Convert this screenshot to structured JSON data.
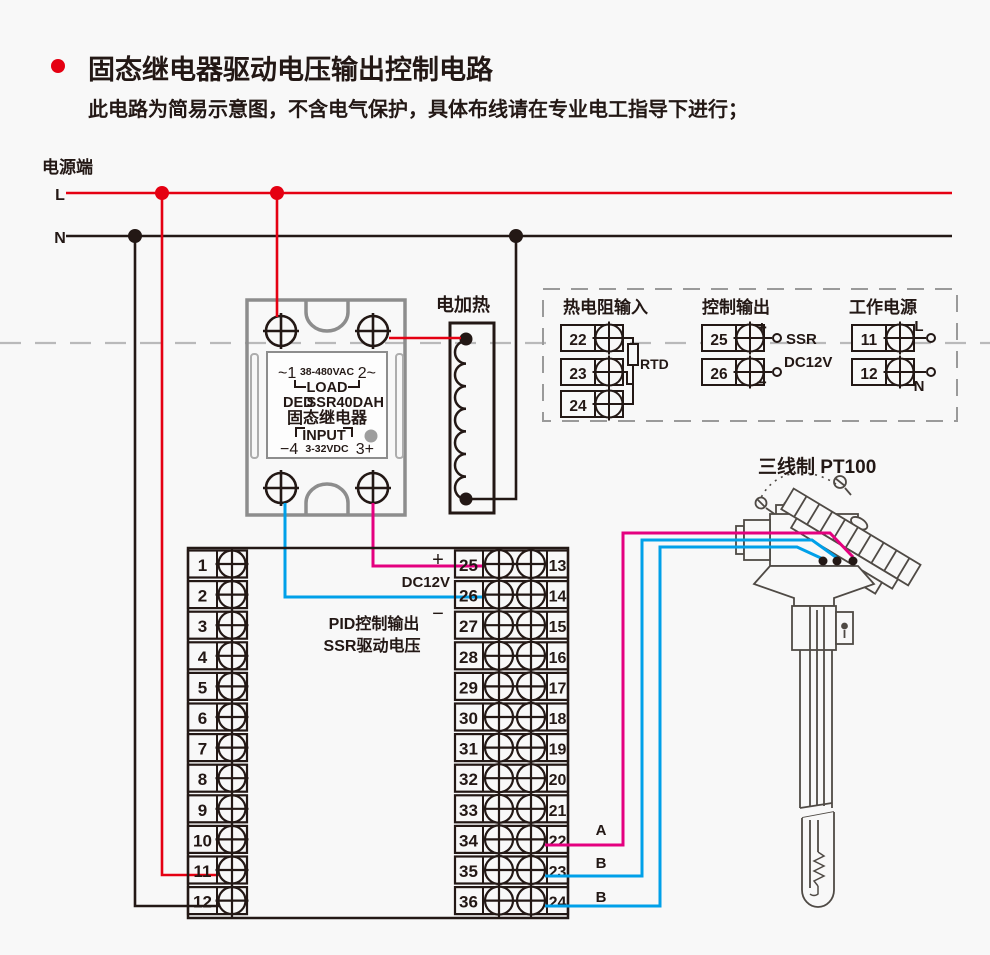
{
  "header": {
    "title": "固态继电器驱动电压输出控制电路",
    "subtitle": "此电路为简易示意图，不含电气保护，具体布线请在专业电工指导下进行；"
  },
  "power": {
    "label": "电源端",
    "line_l": "L",
    "line_n": "N"
  },
  "ssr": {
    "ac_left": "~1",
    "ac_rating": "38-480VAC",
    "ac_right": "2~",
    "load": "LOAD",
    "brand": "DED",
    "model": "SSR40DAH",
    "name": "固态继电器",
    "input": "INPUT",
    "dc_minus": "−4",
    "dc_rating": "3-32VDC",
    "dc_plus": "3+"
  },
  "heater": {
    "label": "电加热"
  },
  "panel": {
    "rtd": {
      "title": "热电阻输入",
      "terminals": [
        "22",
        "23",
        "24"
      ],
      "label": "RTD"
    },
    "ctrl": {
      "title": "控制输出",
      "terminals": [
        "25",
        "26"
      ],
      "plus": "+",
      "minus": "−",
      "ssr_label": "SSR",
      "dc_label": "DC12V"
    },
    "pwr": {
      "title": "工作电源",
      "terminals": [
        "11",
        "12"
      ],
      "l": "L",
      "n": "N"
    }
  },
  "pt100": {
    "label": "三线制 PT100",
    "wire_a": "A",
    "wire_b1": "B",
    "wire_b2": "B"
  },
  "block": {
    "plus": "+",
    "dc12v": "DC12V",
    "minus": "−",
    "pid_line1": "PID控制输出",
    "pid_line2": "SSR驱动电压",
    "left": [
      "1",
      "2",
      "3",
      "4",
      "5",
      "6",
      "7",
      "8",
      "9",
      "10",
      "11",
      "12"
    ],
    "mid": [
      "25",
      "26",
      "27",
      "28",
      "29",
      "30",
      "31",
      "32",
      "33",
      "34",
      "35",
      "36"
    ],
    "right": [
      "13",
      "14",
      "15",
      "16",
      "17",
      "18",
      "19",
      "20",
      "21",
      "22",
      "23",
      "24"
    ]
  },
  "colors": {
    "red": "#e50012",
    "magenta": "#e4007f",
    "blue": "#00a0e9",
    "line": "#231815",
    "grey": "#8d8d8d"
  }
}
